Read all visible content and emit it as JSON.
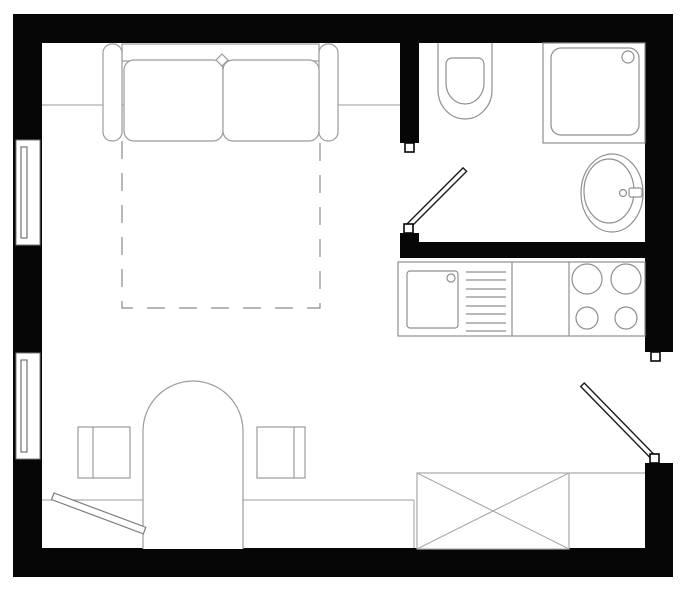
{
  "drawing": {
    "kind": "studio-apartment-floor-plan",
    "background": "#ffffff"
  },
  "colors": {
    "background": "#ffffff",
    "wall": "#060606",
    "furniture_line": "#9b9b9b",
    "fixture_line": "#8f8f8f",
    "door_line": "#1c1c1c",
    "dashed_line": "#8a8a8a",
    "wardrobe_line": "#ababab",
    "window_frame": "#555555"
  },
  "inventory": {
    "windows_count": 2,
    "door_leaves_count": 3,
    "sofa_seat_cushions": 2,
    "stove_burners": 4,
    "chairs_count": 2,
    "elements": [
      "sofa",
      "fold-out-bed-dashed-outline",
      "window-upper-left",
      "window-lower-left",
      "bathroom-door",
      "toilet",
      "shower-tray",
      "washbasin",
      "kitchen-counter",
      "kitchen-sink",
      "drainboard",
      "stove",
      "entrance-door",
      "wardrobe-crossed",
      "dining-table-arched",
      "chair-left",
      "chair-right",
      "floor-door-leaf-bottom-left",
      "bench-line"
    ]
  }
}
